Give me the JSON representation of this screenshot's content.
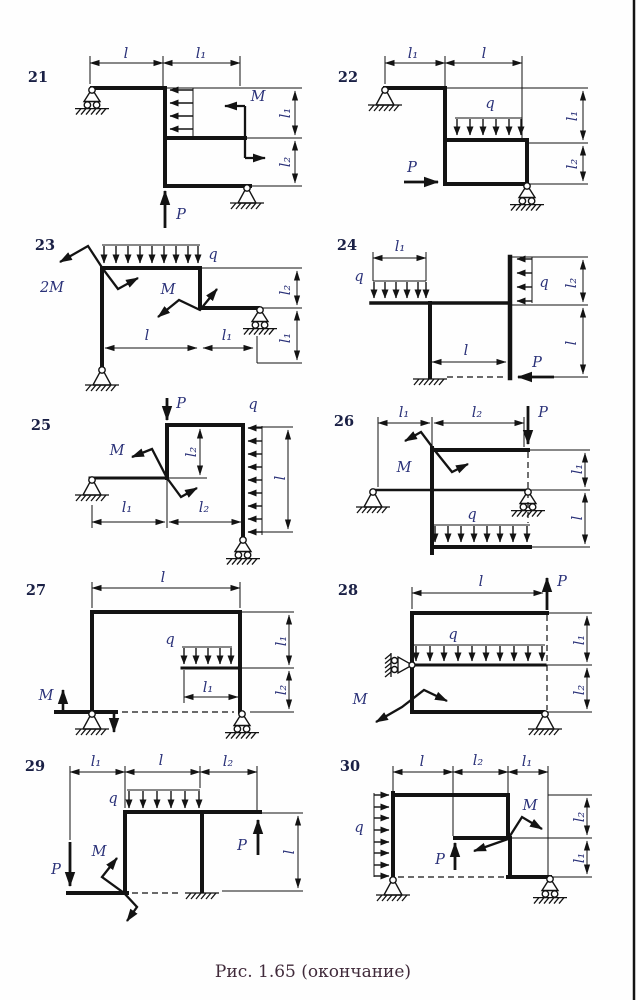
{
  "caption": "Рис. 1.65 (окончание)",
  "labels": {
    "l": "l",
    "l1": "l₁",
    "l2": "l₂",
    "P": "P",
    "M": "M",
    "twoM": "2M",
    "q": "q"
  },
  "diagrams": {
    "d21": {
      "number": "21",
      "visible_labels": [
        "l",
        "l₁",
        "M",
        "l₁",
        "l₂",
        "P"
      ],
      "supports": [
        "roller-top-left",
        "pin-bottom-right"
      ]
    },
    "d22": {
      "number": "22",
      "visible_labels": [
        "l₁",
        "l",
        "q",
        "l₁",
        "l₂",
        "P"
      ],
      "supports": [
        "pin-top-left",
        "roller-bottom-right"
      ]
    },
    "d23": {
      "number": "23",
      "visible_labels": [
        "q",
        "2M",
        "M",
        "l",
        "l₁",
        "l₂",
        "l₁"
      ],
      "supports": [
        "pin-bottom-left",
        "roller-right"
      ]
    },
    "d24": {
      "number": "24",
      "visible_labels": [
        "l₁",
        "q",
        "q",
        "l₂",
        "l",
        "l",
        "P"
      ],
      "supports": [
        "fixed-bottom-left"
      ]
    },
    "d25": {
      "number": "25",
      "visible_labels": [
        "P",
        "q",
        "M",
        "l₂",
        "l",
        "l₁",
        "l₂"
      ],
      "supports": [
        "pin-left",
        "roller-bottom-right"
      ]
    },
    "d26": {
      "number": "26",
      "visible_labels": [
        "l₁",
        "l₂",
        "P",
        "M",
        "q",
        "l₁",
        "l"
      ],
      "supports": [
        "pin-left",
        "roller-middle"
      ]
    },
    "d27": {
      "number": "27",
      "visible_labels": [
        "l",
        "q",
        "l₁",
        "M",
        "l₁",
        "l₂"
      ],
      "supports": [
        "pin-bottom-left",
        "roller-bottom-right"
      ]
    },
    "d28": {
      "number": "28",
      "visible_labels": [
        "l",
        "P",
        "q",
        "M",
        "l₁",
        "l₂"
      ],
      "supports": [
        "wall-roller-left",
        "pin-bottom-right"
      ]
    },
    "d29": {
      "number": "29",
      "visible_labels": [
        "l₁",
        "l",
        "l₂",
        "q",
        "P",
        "M",
        "P",
        "l"
      ],
      "supports": [
        "fixed-bottom"
      ]
    },
    "d30": {
      "number": "30",
      "visible_labels": [
        "l",
        "l₂",
        "l₁",
        "q",
        "M",
        "P",
        "l₂",
        "l₁"
      ],
      "supports": [
        "pin-bottom-left",
        "roller-bottom-right"
      ]
    }
  }
}
